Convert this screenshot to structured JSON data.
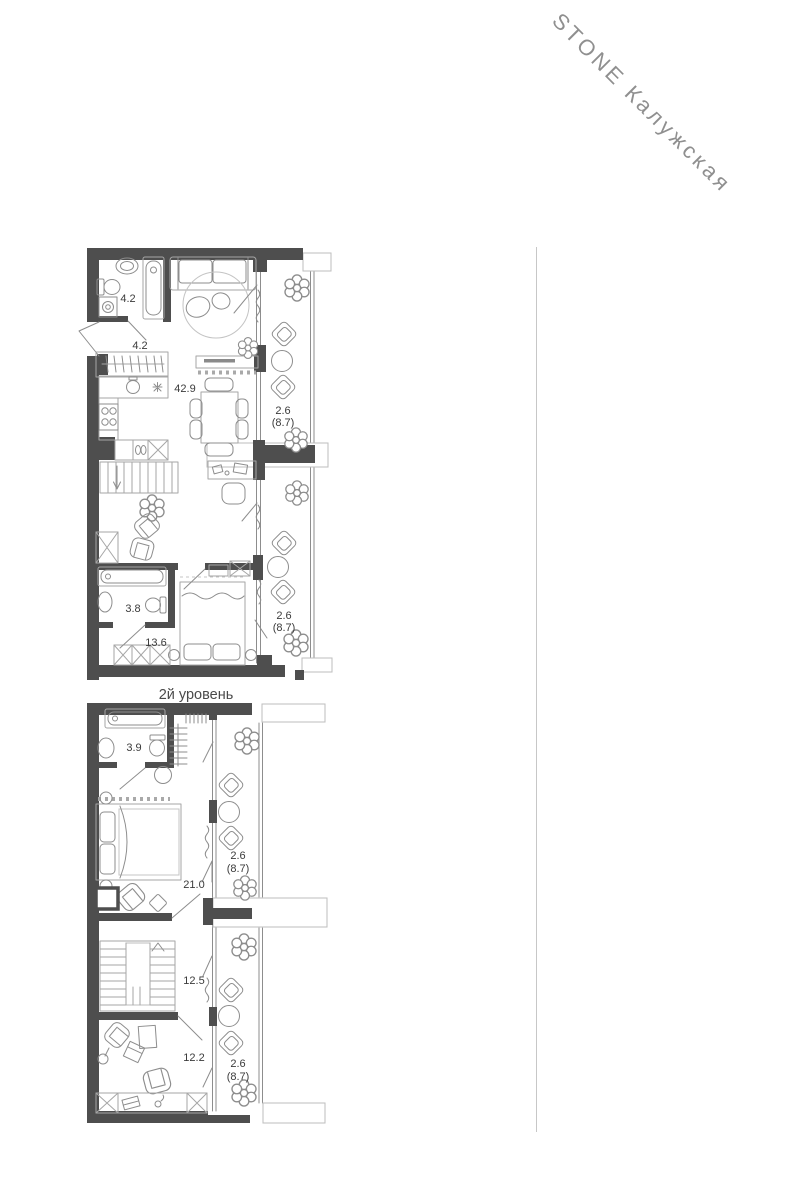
{
  "logo": {
    "brand": "STONE Калужская"
  },
  "plan": {
    "level2_title": "2й уровень",
    "level1": {
      "bathroom1_area": "4.2",
      "hall_area": "4.2",
      "living_area": "42.9",
      "balcony1_area": "2.6",
      "balcony1_total": "(8.7)",
      "balcony2_area": "2.6",
      "balcony2_total": "(8.7)",
      "bathroom2_area": "3.8",
      "bedroom_area": "13.6"
    },
    "level2": {
      "bathroom_area": "3.9",
      "balcony1_area": "2.6",
      "balcony1_total": "(8.7)",
      "bedroom_area": "21.0",
      "hall_area": "12.5",
      "study_area": "12.2",
      "balcony2_area": "2.6",
      "balcony2_total": "(8.7)"
    }
  }
}
